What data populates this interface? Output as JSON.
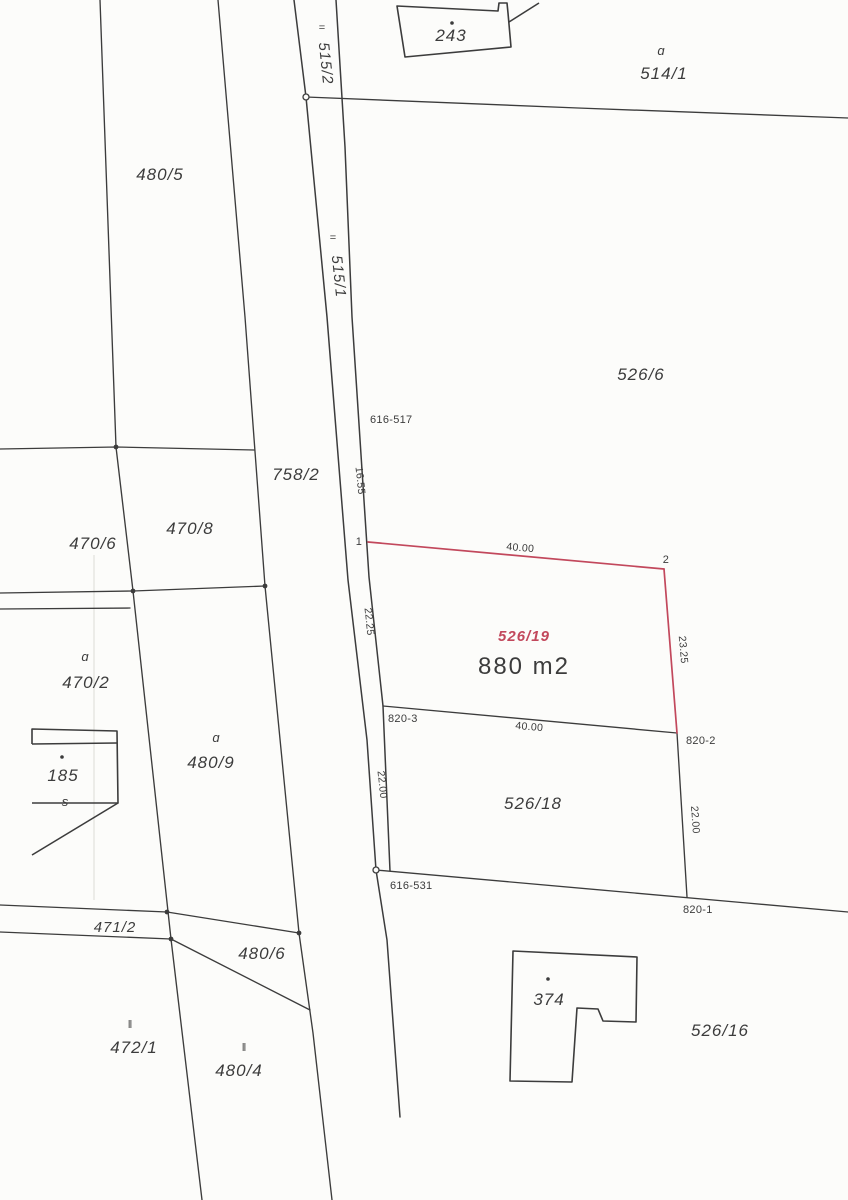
{
  "document_type": "cadastral parcel map (scanned)",
  "colors": {
    "paper": "#fcfcfa",
    "ink": "#3c3c3c",
    "highlight_red": "#c2485c"
  },
  "parcels": {
    "road_upper": "515/2",
    "road_lower": "515/1",
    "p514_1": "514/1",
    "p480_5": "480/5",
    "p526_6": "526/6",
    "p758_2": "758/2",
    "p470_6": "470/6",
    "p470_8": "470/8",
    "p470_2": "470/2",
    "p480_9": "480/9",
    "p526_18": "526/18",
    "p471_2": "471/2",
    "p480_6": "480/6",
    "p472_1": "472/1",
    "p480_4": "480/4",
    "p526_16": "526/16",
    "highlight": "526/19",
    "highlight_area": "880 m2"
  },
  "buildings": {
    "b243": "243",
    "b185": "185",
    "b374": "374"
  },
  "survey_points": {
    "pt_616_517": "616-517",
    "pt_616_531": "616-531",
    "pt_820_1": "820-1",
    "pt_820_2": "820-2",
    "pt_820_3": "820-3",
    "corner_1": "1",
    "corner_2": "2"
  },
  "dimensions": {
    "top_width": "40.00",
    "mid_width": "40.00",
    "road_16_55": "16.55",
    "left_22_25": "22.25",
    "right_23_25": "23.25",
    "left_22_00": "22.00",
    "right_22_00": "22.00"
  },
  "symbols": {
    "road_mark_upper": "=",
    "road_mark_lower": "=",
    "landuse_514_1": "ɑ",
    "landuse_470_2": "ɑ",
    "landuse_480_9": "ɑ",
    "landuse_185": "s",
    "landuse_472_1": "‖",
    "landuse_480_4": "‖"
  }
}
